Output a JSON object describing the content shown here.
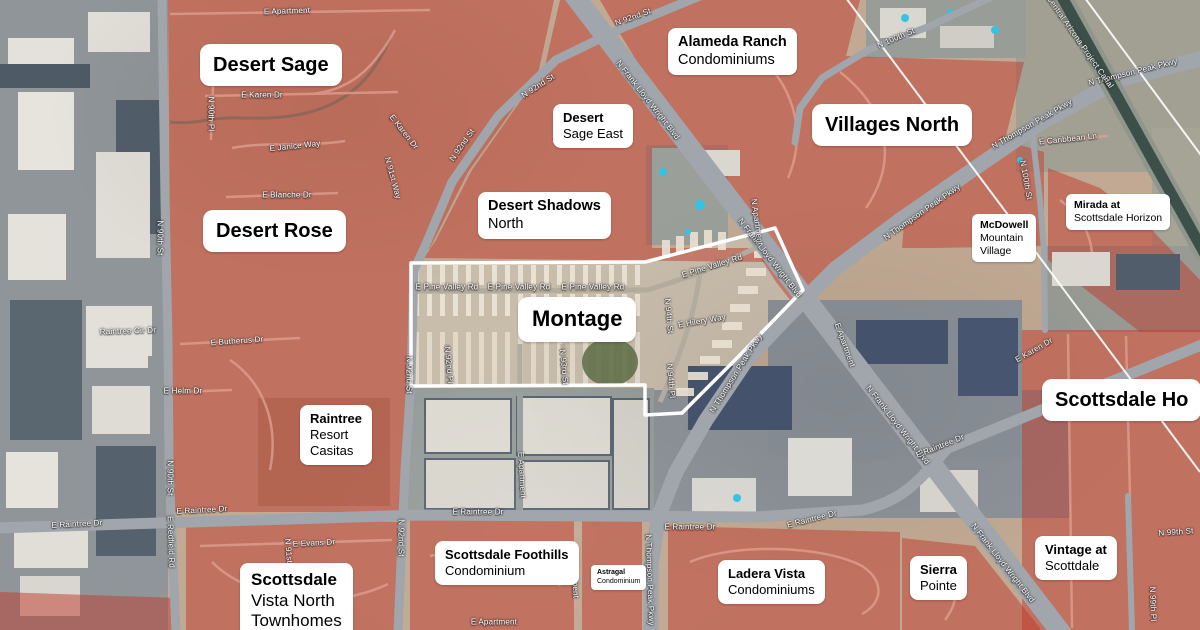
{
  "map_type": "satellite-neighborhood-map",
  "palette": {
    "overlay_red": "#bf3a2b",
    "base_tan": "#c1a993",
    "road_gray": "#a0a6ac",
    "canal_water": "#3c5049",
    "label_bg": "#ffffff",
    "label_text": "#000000",
    "street_label_text": "#ffffff",
    "boundary_white": "#ffffff"
  },
  "neighborhoods": [
    {
      "id": "desert-sage",
      "size": "xl",
      "x": 200,
      "y": 44,
      "lines": [
        [
          "Desert Sage",
          true
        ]
      ]
    },
    {
      "id": "alameda-ranch",
      "size": "md",
      "x": 668,
      "y": 28,
      "lines": [
        [
          "Alameda Ranch",
          true
        ],
        [
          "Condominiums",
          false
        ]
      ]
    },
    {
      "id": "villages-north",
      "size": "xl",
      "x": 812,
      "y": 104,
      "lines": [
        [
          "Villages North",
          true
        ]
      ]
    },
    {
      "id": "desert-sage-east",
      "size": "sm",
      "x": 553,
      "y": 104,
      "lines": [
        [
          "Desert",
          true
        ],
        [
          "Sage East",
          false
        ]
      ]
    },
    {
      "id": "desert-shadows-north",
      "size": "md",
      "x": 478,
      "y": 192,
      "lines": [
        [
          "Desert Shadows",
          true
        ],
        [
          "North",
          false
        ]
      ]
    },
    {
      "id": "desert-rose",
      "size": "xl",
      "x": 203,
      "y": 210,
      "lines": [
        [
          "Desert Rose",
          true
        ]
      ]
    },
    {
      "id": "mirada-at-scottsdale-horizon",
      "size": "xs",
      "x": 1066,
      "y": 194,
      "lines": [
        [
          "Mirada at",
          true
        ],
        [
          "Scottsdale Horizon",
          false
        ]
      ]
    },
    {
      "id": "mcdowell-mountain-village",
      "size": "xs",
      "x": 972,
      "y": 214,
      "lines": [
        [
          "McDowell",
          true
        ],
        [
          "Mountain",
          false
        ],
        [
          "Village",
          false
        ]
      ]
    },
    {
      "id": "montage",
      "size": "xxl",
      "x": 518,
      "y": 297,
      "lines": [
        [
          "Montage",
          true
        ]
      ]
    },
    {
      "id": "scottsdale-horizon",
      "size": "xl",
      "x": 1042,
      "y": 379,
      "lines": [
        [
          "Scottsdale Ho",
          true
        ]
      ]
    },
    {
      "id": "raintree-resort-casitas",
      "size": "sm",
      "x": 300,
      "y": 405,
      "lines": [
        [
          "Raintree",
          true
        ],
        [
          "Resort",
          false
        ],
        [
          "Casitas",
          false
        ]
      ]
    },
    {
      "id": "scottsdale-vista-north",
      "size": "lg",
      "x": 240,
      "y": 563,
      "lines": [
        [
          "Scottsdale",
          true
        ],
        [
          "Vista North",
          false
        ],
        [
          "Townhomes",
          false
        ]
      ]
    },
    {
      "id": "scottsdale-foothills",
      "size": "sm",
      "x": 435,
      "y": 541,
      "lines": [
        [
          "Scottsdale Foothills",
          true
        ],
        [
          "Condominium",
          false
        ]
      ]
    },
    {
      "id": "astragal",
      "size": "xxs",
      "x": 591,
      "y": 565,
      "lines": [
        [
          "Astragal",
          true
        ],
        [
          "Condominium",
          false
        ]
      ]
    },
    {
      "id": "ladera-vista",
      "size": "sm",
      "x": 718,
      "y": 560,
      "lines": [
        [
          "Ladera Vista",
          true
        ],
        [
          "Condominiums",
          false
        ]
      ]
    },
    {
      "id": "sierra-pointe",
      "size": "sm",
      "x": 910,
      "y": 556,
      "lines": [
        [
          "Sierra",
          true
        ],
        [
          "Pointe",
          false
        ]
      ]
    },
    {
      "id": "vintage-at-scottdale",
      "size": "sm",
      "x": 1035,
      "y": 536,
      "lines": [
        [
          "Vintage at",
          true
        ],
        [
          "Scottdale",
          false
        ]
      ]
    }
  ],
  "streets": [
    {
      "label": "E Apartment",
      "x": 287,
      "y": 11,
      "r": -2
    },
    {
      "label": "N 92nd St",
      "x": 633,
      "y": 17,
      "r": -20
    },
    {
      "label": "N 92nd St",
      "x": 538,
      "y": 86,
      "r": -33
    },
    {
      "label": "N 92nd St",
      "x": 462,
      "y": 145,
      "r": -55
    },
    {
      "label": "N 92nd St",
      "x": 409,
      "y": 375,
      "r": 90
    },
    {
      "label": "N 92nd St",
      "x": 401,
      "y": 538,
      "r": 90
    },
    {
      "label": "N Frank Lloyd Wright Blvd",
      "x": 648,
      "y": 100,
      "r": 52
    },
    {
      "label": "N Frank Lloyd Wright Blvd",
      "x": 770,
      "y": 258,
      "r": 52
    },
    {
      "label": "N Frank Lloyd Wright Blvd",
      "x": 898,
      "y": 425,
      "r": 52
    },
    {
      "label": "N Frank Lloyd Wright Blvd",
      "x": 1003,
      "y": 563,
      "r": 52
    },
    {
      "label": "E Karen Dr",
      "x": 262,
      "y": 95,
      "r": 0
    },
    {
      "label": "E Karen Dr",
      "x": 404,
      "y": 132,
      "r": 52
    },
    {
      "label": "E Janice Way",
      "x": 295,
      "y": 146,
      "r": -6
    },
    {
      "label": "E Blanche Dr",
      "x": 287,
      "y": 195,
      "r": 0
    },
    {
      "label": "N 90th Pl",
      "x": 211,
      "y": 114,
      "r": 90
    },
    {
      "label": "N 91st Way",
      "x": 393,
      "y": 178,
      "r": 75
    },
    {
      "label": "N 90th St",
      "x": 160,
      "y": 238,
      "r": 90
    },
    {
      "label": "N 90th St",
      "x": 170,
      "y": 478,
      "r": 90
    },
    {
      "label": "Raintree Cir Dr",
      "x": 128,
      "y": 331,
      "r": -2
    },
    {
      "label": "E Butherus Dr",
      "x": 237,
      "y": 341,
      "r": -4
    },
    {
      "label": "E Helm Dr",
      "x": 183,
      "y": 391,
      "r": 0
    },
    {
      "label": "E Raintree Dr",
      "x": 77,
      "y": 524,
      "r": -3
    },
    {
      "label": "E Raintree Dr",
      "x": 202,
      "y": 510,
      "r": -3
    },
    {
      "label": "E Raintree Dr",
      "x": 478,
      "y": 512,
      "r": 0
    },
    {
      "label": "E Raintree Dr",
      "x": 690,
      "y": 527,
      "r": 0
    },
    {
      "label": "E Raintree Dr",
      "x": 812,
      "y": 519,
      "r": -14
    },
    {
      "label": "E Raintree Dr",
      "x": 940,
      "y": 446,
      "r": -22
    },
    {
      "label": "E Redfield Rd",
      "x": 171,
      "y": 542,
      "r": 88
    },
    {
      "label": "E Evans Dr",
      "x": 314,
      "y": 543,
      "r": -3
    },
    {
      "label": "N 91st St",
      "x": 289,
      "y": 556,
      "r": 85
    },
    {
      "label": "E Pine Valley Rd",
      "x": 447,
      "y": 287,
      "r": 0
    },
    {
      "label": "E Pine Valley Rd",
      "x": 519,
      "y": 287,
      "r": 0
    },
    {
      "label": "E Pine Valley Rd",
      "x": 593,
      "y": 287,
      "r": 0
    },
    {
      "label": "E Pine Valley Rd",
      "x": 712,
      "y": 266,
      "r": -17
    },
    {
      "label": "N 92nd Pl",
      "x": 449,
      "y": 365,
      "r": 85
    },
    {
      "label": "N 93rd St",
      "x": 564,
      "y": 367,
      "r": 85
    },
    {
      "label": "N 94th St",
      "x": 669,
      "y": 316,
      "r": 85
    },
    {
      "label": "E Hilery Way",
      "x": 702,
      "y": 321,
      "r": -10
    },
    {
      "label": "N 94th Pl",
      "x": 671,
      "y": 381,
      "r": 85
    },
    {
      "label": "E Apartment",
      "x": 522,
      "y": 475,
      "r": 87
    },
    {
      "label": "E Apartment",
      "x": 494,
      "y": 622,
      "r": 0
    },
    {
      "label": "E Apartment",
      "x": 575,
      "y": 575,
      "r": 88
    },
    {
      "label": "E Apartment",
      "x": 845,
      "y": 345,
      "r": 70
    },
    {
      "label": "N Apartment",
      "x": 757,
      "y": 222,
      "r": 82
    },
    {
      "label": "N Thompson Peak Pkwy",
      "x": 1133,
      "y": 72,
      "r": -14
    },
    {
      "label": "N Thompson Peak Pkwy",
      "x": 1032,
      "y": 124,
      "r": -30
    },
    {
      "label": "N Thompson Peak Pkwy",
      "x": 922,
      "y": 212,
      "r": -35
    },
    {
      "label": "N Thompson Peak Pkwy",
      "x": 736,
      "y": 373,
      "r": -58
    },
    {
      "label": "N Thompson Peak Pkwy",
      "x": 650,
      "y": 580,
      "r": 88
    },
    {
      "label": "N 100th St",
      "x": 896,
      "y": 38,
      "r": -23
    },
    {
      "label": "N 100th St",
      "x": 1026,
      "y": 180,
      "r": 80
    },
    {
      "label": "Central Arizona Project Canal",
      "x": 1080,
      "y": 42,
      "r": 55
    },
    {
      "label": "E Caribbean Ln",
      "x": 1068,
      "y": 139,
      "r": -6
    },
    {
      "label": "E Karen Dr",
      "x": 1034,
      "y": 350,
      "r": -30
    },
    {
      "label": "N 99th St",
      "x": 1176,
      "y": 532,
      "r": -4
    },
    {
      "label": "N 99th Pl",
      "x": 1153,
      "y": 604,
      "r": 88
    }
  ]
}
